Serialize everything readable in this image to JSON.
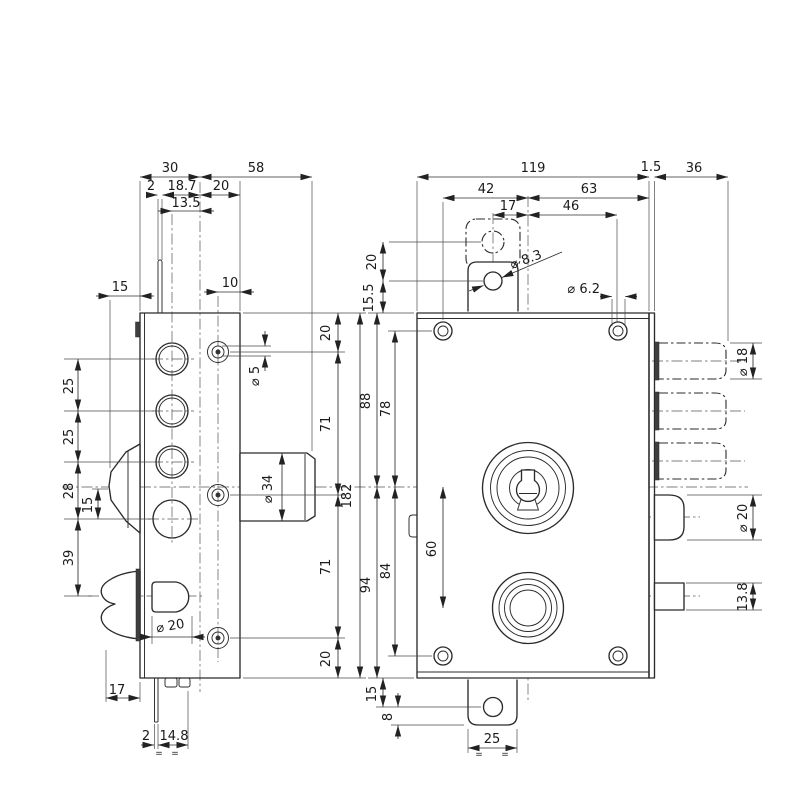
{
  "page": {
    "background": "#ffffff",
    "line_color": "#2b2b2b"
  },
  "side_view": {
    "dims": {
      "d30": "30",
      "d58": "58",
      "d2_top": "2",
      "d18_7": "18.7",
      "d20_top": "20",
      "d13_5": "13.5",
      "d15_top": "15",
      "d10": "10",
      "d25_a": "25",
      "d25_b": "25",
      "d28": "28",
      "d15_cam": "15",
      "d39": "39",
      "dia5": "⌀ 5",
      "dia34": "⌀ 34",
      "dia20": "⌀ 20",
      "d17": "17",
      "d2_bottom": "2",
      "d14_8": "14.8",
      "eq_left": "=",
      "eq_right": "=",
      "d20_col_top": "20",
      "d71_col_top": "71",
      "d182": "182",
      "d71_col_bottom": "71",
      "d20_col_bottom": "20"
    }
  },
  "front_view": {
    "dims": {
      "d119": "119",
      "d1_5": "1.5",
      "d36": "36",
      "d42": "42",
      "d63": "63",
      "d17": "17",
      "d46": "46",
      "dia8_3": "⌀ 8.3",
      "dia6_2": "⌀ 6.2",
      "d20_tab": "20",
      "d15_5": "15.5",
      "d88": "88",
      "d78": "78",
      "d94": "94",
      "d84": "84",
      "d60": "60",
      "d15_tab": "15",
      "d8_tab": "8",
      "d25_tab": "25",
      "eq_left": "=",
      "eq_right": "=",
      "dia18": "⌀ 18",
      "dia20": "⌀ 20",
      "d13_8": "13.8"
    }
  }
}
